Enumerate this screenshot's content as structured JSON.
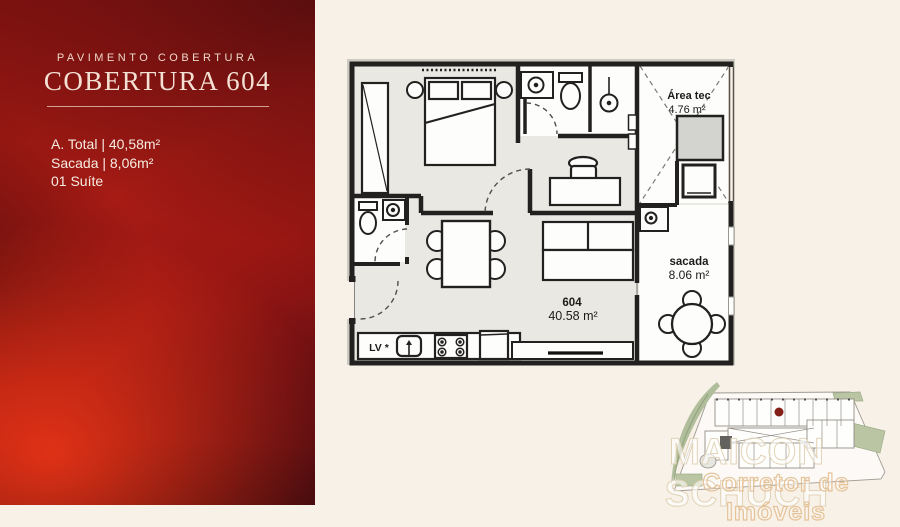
{
  "panel": {
    "eyebrow": "PAVIMENTO COBERTURA",
    "title": "COBERTURA 604",
    "stats": [
      "A. Total | 40,58m²",
      "Sacada | 8,06m²",
      "01 Suíte"
    ],
    "accent_color": "#a81b14",
    "text_color": "#f7ece2"
  },
  "plan": {
    "area_tec": {
      "name": "Área tec",
      "area": "4.76 m²"
    },
    "sacada": {
      "name": "sacada",
      "area": "8.06 m²"
    },
    "unit": {
      "number": "604",
      "area": "40.58 m²"
    },
    "kitchen": {
      "dishwasher_label": "LV *"
    },
    "wall_color": "#232120",
    "floor_color": "#e9e8e3",
    "room_color": "#fdfdfc"
  },
  "watermark": {
    "name": "MAICON SCHUCH",
    "subtitle": "Corretor de Imóveis"
  },
  "page": {
    "background": "#f8f1e7"
  }
}
